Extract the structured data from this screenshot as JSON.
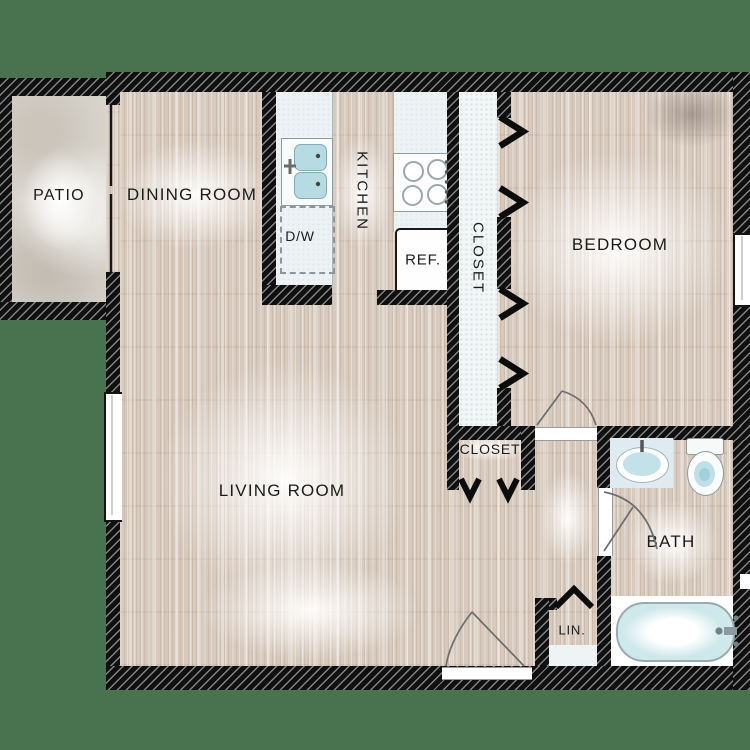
{
  "plan_title": "One-bedroom apartment floor plan",
  "colors": {
    "background": "#49724f",
    "wall": "#101010",
    "wall_hatch": "#848484",
    "wood_floor": "#d6c9bd",
    "patio_stone": "#d8d4cc",
    "counter": "#edf3f5",
    "fixture_blue": "#c2e1e8"
  },
  "rooms": {
    "patio": "PATIO",
    "dining_room": "DINING ROOM",
    "kitchen": "KITCHEN",
    "hall_closet": "CLOSET",
    "bedroom": "BEDROOM",
    "living_room": "LIVING ROOM",
    "entry_closet": "CLOSET",
    "bath": "BATH",
    "linen_closet": "LIN."
  },
  "appliances": {
    "dishwasher": "D/W",
    "refrigerator": "REF."
  }
}
